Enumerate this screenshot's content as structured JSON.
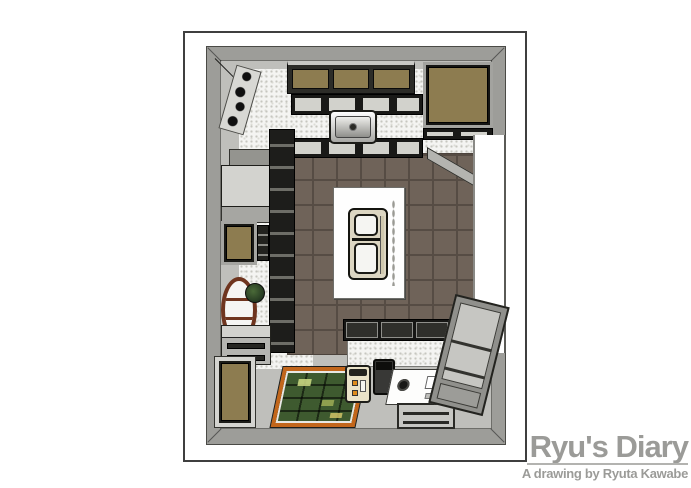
{
  "signature": {
    "title": "Ryu's Diary",
    "subtitle": "A drawing by Ryuta Kawabe"
  },
  "palette": {
    "page_bg": "#ffffff",
    "frame_border": "#3f3f3f",
    "wall": "#9d9d99",
    "floor_gray": "#bfbfbb",
    "terrazzo": "#f4f4f2",
    "terrazzo_dot": "#c6c6c0",
    "tile": "#6f6359",
    "tile_grout": "#564c44",
    "cabinet_tan": "#8d7c50",
    "cabinet_top_gray": "#d3d3cf",
    "island_white": "#fefefe",
    "bench_gray": "#acaca8",
    "rug_green": "#3e5a2f",
    "rug_border": "#c2661b",
    "rug_accent": "#cfdd85",
    "appliance_cream": "#eae3c9",
    "appliance_orange": "#dd8b1c",
    "table_wood": "#6f351f",
    "signature": "#9b9b98"
  }
}
